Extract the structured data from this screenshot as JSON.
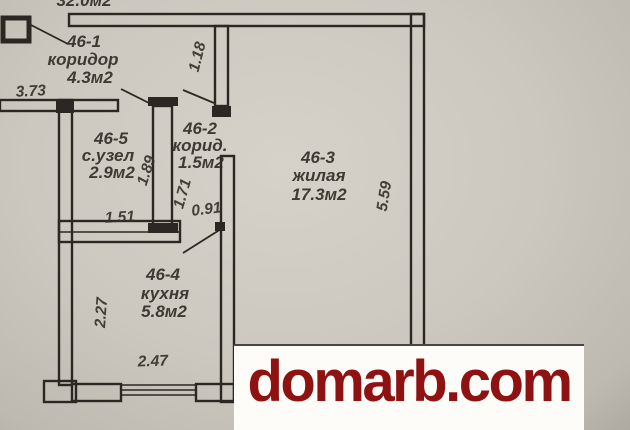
{
  "top_label": {
    "partial_area_text": "32.0м2"
  },
  "rooms": [
    {
      "id": "46-1",
      "name": "коридор",
      "area": "4.3м2"
    },
    {
      "id": "46-2",
      "name": "корид.",
      "area": "1.5м2"
    },
    {
      "id": "46-3",
      "name": "жилая",
      "area": "17.3м2"
    },
    {
      "id": "46-4",
      "name": "кухня",
      "area": "5.8м2"
    },
    {
      "id": "46-5",
      "name": "с.узел",
      "area": "2.9м2"
    }
  ],
  "dimensions": {
    "d373": "3.73",
    "d118": "1.18",
    "d189": "1.89",
    "d151": "1.51",
    "d171": "1.71",
    "d091": "0.91",
    "d559": "5.59",
    "d227": "2.27",
    "d247": "2.47"
  },
  "watermark": {
    "text": "domarb.com"
  },
  "colors": {
    "paper": "#ccc8bf",
    "ink": "#2b2823",
    "watermark_red": "#8e1212",
    "watermark_bg": "#fdfcf9"
  }
}
